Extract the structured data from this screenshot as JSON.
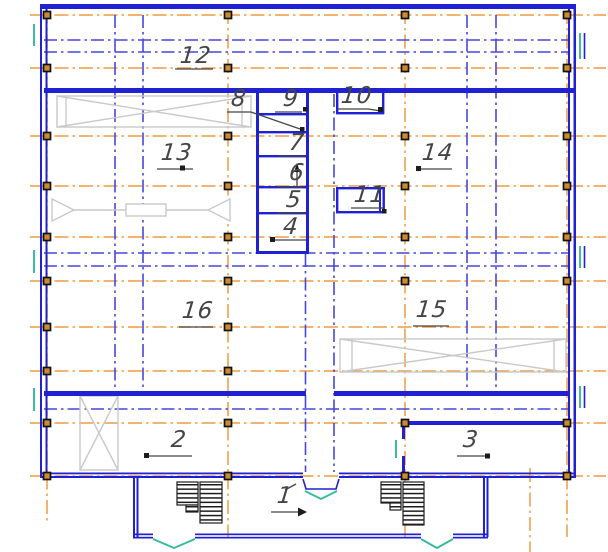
{
  "drawing": {
    "room_labels": {
      "r1": "1",
      "r2": "2",
      "r3": "3",
      "r4": "4",
      "r5": "5",
      "r6": "6",
      "r7": "7",
      "r8": "8",
      "r9": "9",
      "r10": "10",
      "r11": "11",
      "r12": "12",
      "r13": "13",
      "r14": "14",
      "r15": "15",
      "r16": "16"
    }
  },
  "colors": {
    "wall": "#2121d4",
    "axblue": "#4646de",
    "orange": "#f09b42",
    "teal": "#35b9a0",
    "gray": "#c9c9c9",
    "colfill": "#cd8a2e",
    "label": "#454545"
  }
}
